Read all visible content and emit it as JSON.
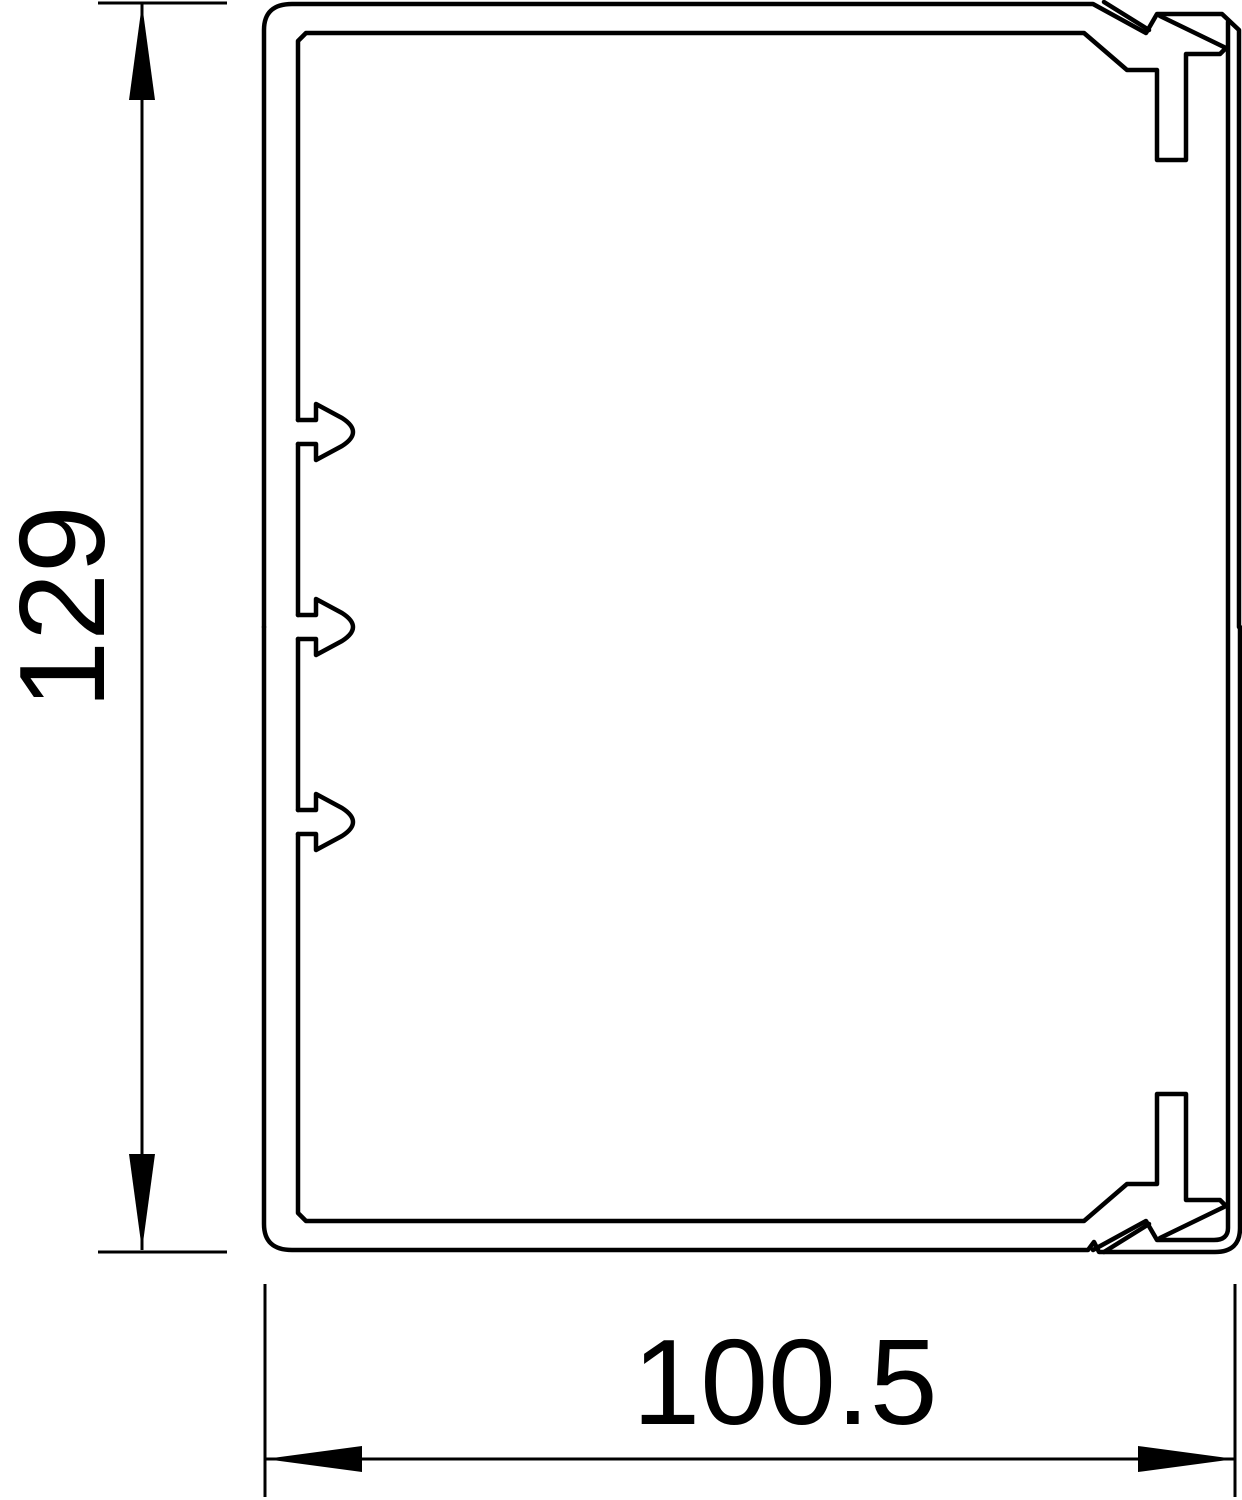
{
  "page": {
    "background": "#ffffff"
  },
  "drawing": {
    "kind": "technical-cross-section",
    "subject": "rectangular cable trunking profile (base channel with snap-on lid details)",
    "stroke_color": "#000000",
    "fill_color": "#ffffff",
    "profile": {
      "left_wall_latches": 3,
      "snap_hooks": [
        "top-right",
        "bottom-right"
      ],
      "corners": "chamfered / rounded"
    },
    "dimensions": {
      "height": {
        "value": "129",
        "orientation": "vertical",
        "side": "left",
        "arrow_style": "filled slender triangles, pointing outward"
      },
      "width": {
        "value": "100.5",
        "orientation": "horizontal",
        "side": "bottom",
        "arrow_style": "filled slender triangles, pointing outward"
      }
    }
  }
}
